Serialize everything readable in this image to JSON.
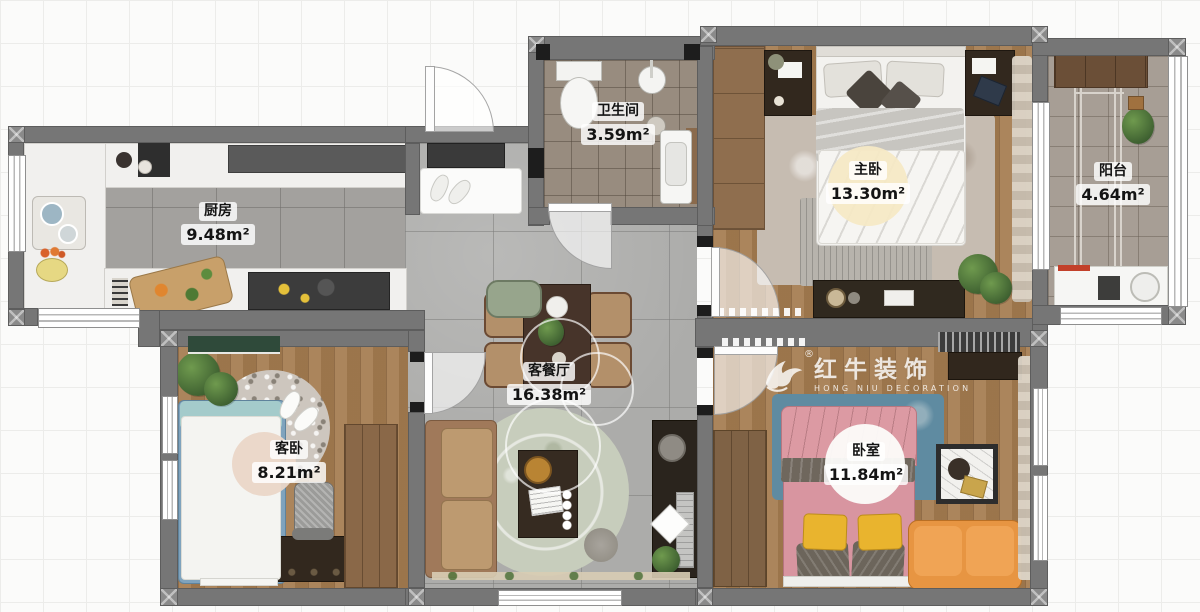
{
  "watermark": {
    "reg": "®",
    "brand_cn": "红牛装饰",
    "brand_en": "HONG NIU DECORATION",
    "logo": "bull-icon"
  },
  "rooms": {
    "kitchen": {
      "name": "厨房",
      "area": "9.48m²"
    },
    "bathroom": {
      "name": "卫生间",
      "area": "3.59m²"
    },
    "master_bedroom": {
      "name": "主卧",
      "area": "13.30m²"
    },
    "balcony": {
      "name": "阳台",
      "area": "4.64m²"
    },
    "living_dining": {
      "name": "客餐厅",
      "area": "16.38m²"
    },
    "guest_bedroom": {
      "name": "客卧",
      "area": "8.21m²"
    },
    "bedroom": {
      "name": "卧室",
      "area": "11.84m²"
    }
  },
  "palette": {
    "wall": "#767676",
    "wood_floor": "#a57c50",
    "marble_floor": "#acacaa",
    "kitchen_tile": "#a3a19e",
    "bath_tile": "#988c7f",
    "balcony_tile": "#a79e95",
    "sofa_tan": "#b58e63",
    "rug_sage": "#c7cdbc",
    "bed_pink": "#d895a0",
    "pillow_yellow": "#e9b42e",
    "sofa_orange": "#e79542",
    "rug_blue": "#5f8ba1",
    "bed_blue": "#7fa3bd",
    "label_text": "#141414"
  }
}
